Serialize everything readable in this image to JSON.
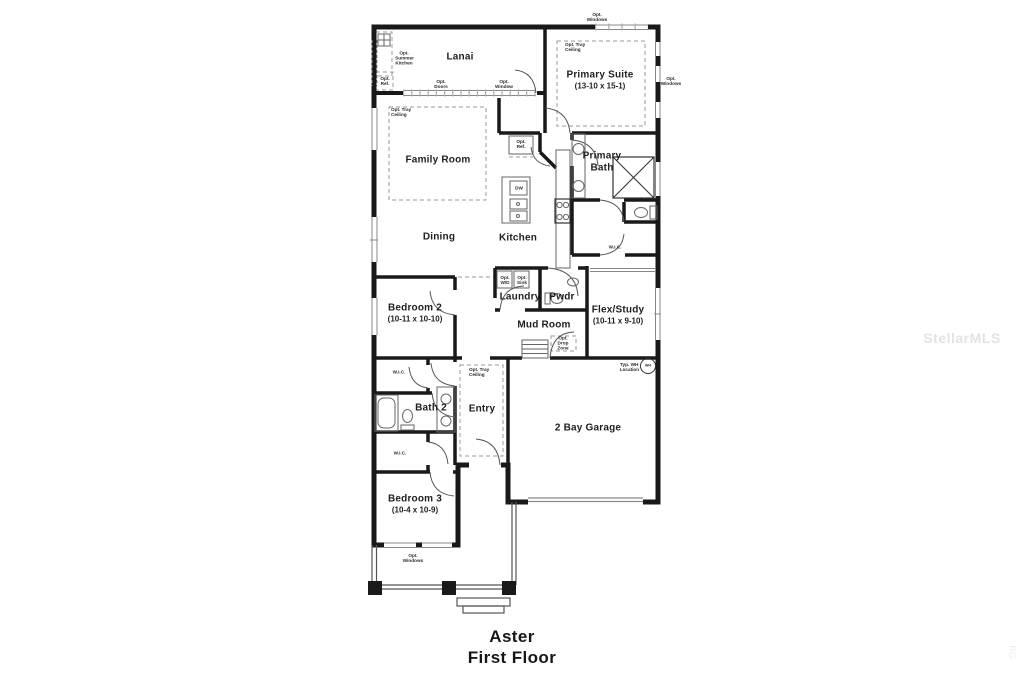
{
  "plan": {
    "title_line1": "Aster",
    "title_line2": "First Floor",
    "watermark": "StellarMLS",
    "watermark_corner": "RG"
  },
  "colors": {
    "wall": "#191919",
    "thin_line": "#666666",
    "dashed_line": "#999999",
    "label_text": "#1f1f1f",
    "watermark": "#e3e3e3"
  },
  "rooms": {
    "lanai": {
      "name": "Lanai"
    },
    "primary_suite": {
      "name": "Primary Suite",
      "dim": "(13-10 x 15-1)"
    },
    "family_room": {
      "name": "Family Room"
    },
    "dining": {
      "name": "Dining"
    },
    "kitchen": {
      "name": "Kitchen"
    },
    "primary_bath": {
      "name": "Primary Bath"
    },
    "bedroom2": {
      "name": "Bedroom 2",
      "dim": "(10-11 x 10-10)"
    },
    "laundry": {
      "name": "Laundry"
    },
    "pwdr": {
      "name": "Pwdr"
    },
    "flex_study": {
      "name": "Flex/Study",
      "dim": "(10-11 x 9-10)"
    },
    "mud_room": {
      "name": "Mud Room"
    },
    "bath2": {
      "name": "Bath 2"
    },
    "entry": {
      "name": "Entry"
    },
    "garage": {
      "name": "2 Bay Garage"
    },
    "bedroom3": {
      "name": "Bedroom 3",
      "dim": "(10-4 x 10-9)"
    }
  },
  "annotations": {
    "opt_windows": "Opt. Windows",
    "opt_summer_kitchen": "Opt. Summer Kitchen",
    "opt_ref": "Opt. Ref.",
    "opt_doors": "Opt. Doors",
    "opt_window": "Opt. Window",
    "opt_tray_ceiling": "Opt. Tray Ceiling",
    "opt_wd": "Opt. W/D",
    "opt_sink": "Opt. Sink",
    "opt_drop_zone": "Opt. Drop Zone",
    "wic": "W.I.C.",
    "dw": "DW",
    "wh_location": "Typ. WH Location",
    "wh": "WH"
  }
}
